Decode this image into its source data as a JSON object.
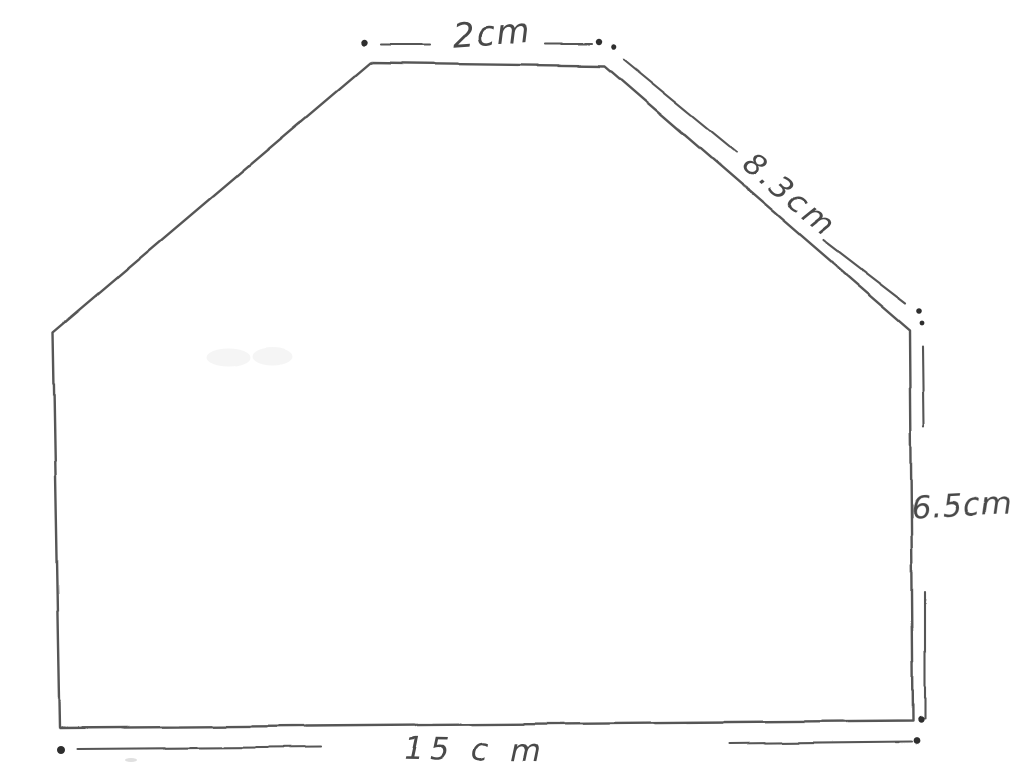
{
  "diagram": {
    "kind": "hand-drawn polygon measurement sketch",
    "colors": {
      "paper": "#ffffff",
      "ink": "#565656",
      "dots": "#2e2e2e",
      "text": "#4a4a4a"
    }
  },
  "labels": {
    "top": {
      "text": "2cm",
      "x": 493,
      "y": 45,
      "size": 34,
      "rotate": -4,
      "spacing": 2
    },
    "slant": {
      "text": "8.3cm",
      "x": 783,
      "y": 203,
      "size": 31,
      "rotate": 40,
      "spacing": 3
    },
    "right": {
      "text": "6.5cm",
      "x": 962,
      "y": 516,
      "size": 31,
      "rotate": -3,
      "spacing": 1
    },
    "bottom": {
      "text": "15 c m",
      "x": 475,
      "y": 760,
      "size": 31,
      "rotate": 1,
      "spacing": 6
    }
  },
  "shape": {
    "vertices": [
      [
        370,
        63
      ],
      [
        605,
        66
      ],
      [
        910,
        330
      ],
      [
        913,
        721
      ],
      [
        60,
        728
      ],
      [
        53,
        332
      ]
    ],
    "stroke_width": 2.4
  },
  "dimensions": {
    "stroke_width": 2.1,
    "segments": [
      {
        "x1": 381,
        "y1": 45,
        "x2": 429,
        "y2": 45
      },
      {
        "x1": 546,
        "y1": 44,
        "x2": 592,
        "y2": 44
      },
      {
        "x1": 624,
        "y1": 60,
        "x2": 736,
        "y2": 152
      },
      {
        "x1": 823,
        "y1": 240,
        "x2": 905,
        "y2": 303
      },
      {
        "x1": 923,
        "y1": 346,
        "x2": 924,
        "y2": 427
      },
      {
        "x1": 925,
        "y1": 592,
        "x2": 925,
        "y2": 719
      },
      {
        "x1": 78,
        "y1": 749,
        "x2": 321,
        "y2": 747
      },
      {
        "x1": 729,
        "y1": 744,
        "x2": 911,
        "y2": 742
      }
    ],
    "dots": [
      {
        "x": 364,
        "y": 43,
        "r": 3.2
      },
      {
        "x": 599,
        "y": 42,
        "r": 3.2
      },
      {
        "x": 614,
        "y": 47,
        "r": 2.8
      },
      {
        "x": 919,
        "y": 311,
        "r": 2.8
      },
      {
        "x": 922,
        "y": 323,
        "r": 2.4
      },
      {
        "x": 921,
        "y": 720,
        "r": 3.2
      },
      {
        "x": 916,
        "y": 741,
        "r": 3.4
      },
      {
        "x": 61,
        "y": 750,
        "r": 4.0
      }
    ]
  },
  "artifacts": [
    {
      "x": 228,
      "y": 358,
      "rx": 22,
      "ry": 9,
      "opacity": 0.04
    },
    {
      "x": 272,
      "y": 357,
      "rx": 20,
      "ry": 9,
      "opacity": 0.04
    },
    {
      "x": 131,
      "y": 760,
      "rx": 6,
      "ry": 2,
      "opacity": 0.12
    }
  ]
}
